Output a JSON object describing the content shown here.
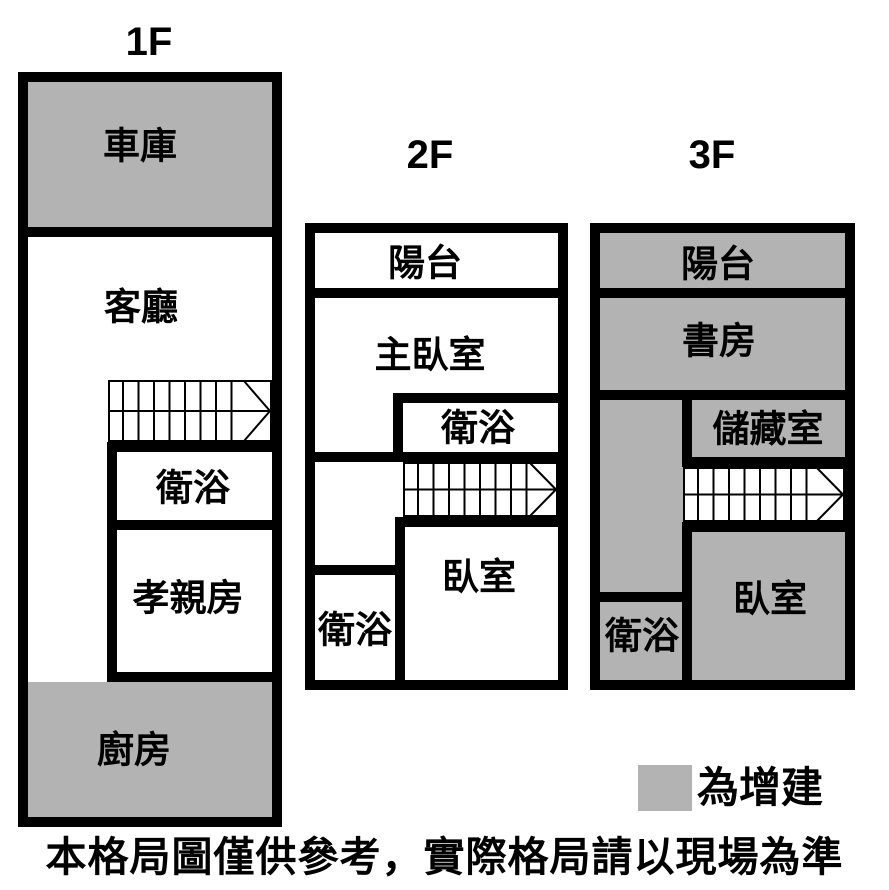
{
  "colors": {
    "wall": "#000000",
    "addition_gray": "#b3b3b3",
    "room_white": "#ffffff"
  },
  "floors": [
    {
      "title": "1F",
      "rooms": {
        "garage": "車庫",
        "living_room": "客廳",
        "bathroom": "衛浴",
        "parents_room": "孝親房",
        "kitchen": "廚房"
      }
    },
    {
      "title": "2F",
      "rooms": {
        "balcony": "陽台",
        "master_bedroom": "主臥室",
        "bathroom_upper": "衛浴",
        "bedroom": "臥室",
        "bathroom_lower": "衛浴"
      }
    },
    {
      "title": "3F",
      "rooms": {
        "balcony": "陽台",
        "study": "書房",
        "storage": "儲藏室",
        "bedroom": "臥室",
        "bathroom": "衛浴"
      }
    }
  ],
  "legend": {
    "label": "為增建",
    "swatch_color": "#b3b3b3"
  },
  "disclaimer": "本格局圖僅供參考，實際格局請以現場為準"
}
